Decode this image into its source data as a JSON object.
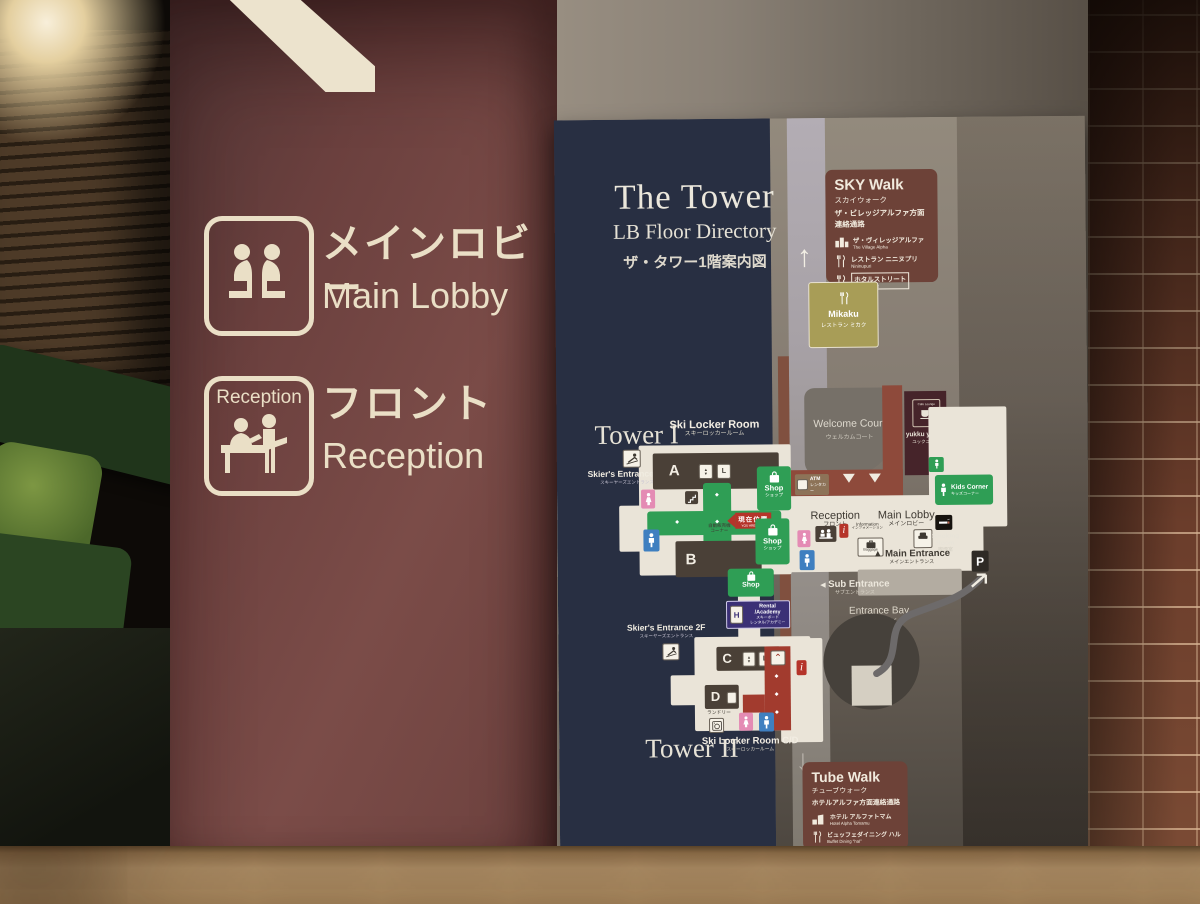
{
  "colors": {
    "wall_maroon": "#714543",
    "sign_cream": "#eadfc6",
    "board_navy": "#272e40",
    "board_gray": "#8c8379",
    "box_maroon": "#6d4238",
    "mikaku_olive": "#a89d57",
    "map_cream": "#eae4d8",
    "map_brown": "#4a4037",
    "map_green": "#2f9e55",
    "map_red": "#a23b2e",
    "rental_purple": "#3b3076",
    "marker_red": "#b5342a"
  },
  "wall_signs": {
    "main_lobby": {
      "jp": "メインロビー",
      "en": "Main Lobby"
    },
    "reception": {
      "box_label": "Reception",
      "jp": "フロント",
      "en": "Reception"
    }
  },
  "board": {
    "title": "The Tower",
    "subtitle": "LB Floor Directory",
    "subtitle_jp": "ザ・タワー1階案内図",
    "tower_1": "Tower I",
    "tower_2": "Tower II",
    "sky_walk": {
      "title": "SKY Walk",
      "jp": "スカイウォーク",
      "dest_line1": "ザ・ビレッジアルファ方面",
      "dest_line2": "連絡通路",
      "items": [
        {
          "icon": "village-building-icon",
          "jp": "ザ・ヴィレッジアルファ",
          "en": "The Village Alpha"
        },
        {
          "icon": "restaurant-icon",
          "jp": "レストラン ニニヌプリ",
          "en": "Nininupuri"
        },
        {
          "icon": "restaurant-icon",
          "jp": "ホタルストリート",
          "en": "hotalu street"
        }
      ]
    },
    "tube_walk": {
      "title": "Tube Walk",
      "jp": "チューブウォーク",
      "dest_line1": "ホテルアルファ方面連絡通路",
      "items": [
        {
          "icon": "hotel-building-icon",
          "jp": "ホテル アルファトマム",
          "en": "Hotel Alpha Tomamu"
        },
        {
          "icon": "restaurant-icon",
          "jp": "ビュッフェダイニング ハル",
          "en": "Buffet Dining \"hal\""
        }
      ]
    },
    "mikaku": {
      "en": "Mikaku",
      "jp": "レストラン ミカク"
    },
    "welcome_court": {
      "en": "Welcome Court",
      "jp": "ウェルカムコート"
    },
    "yukku": {
      "tag": "Cafe Lounge",
      "en": "yukku yukku",
      "jp": "ユックユック"
    },
    "map": {
      "ski_locker": {
        "en": "Ski Locker Room",
        "jp": "スキーロッカールーム"
      },
      "ski_locker_cd": {
        "en": "Ski Locker Room C/D",
        "jp": "スキーロッカールーム"
      },
      "skiers_entrance": {
        "en": "Skier's Entrance 2F",
        "jp": "スキーヤーズエントランス"
      },
      "reception": {
        "en": "Reception",
        "jp": "フロント"
      },
      "main_lobby": {
        "en": "Main Lobby",
        "jp": "メインロビー"
      },
      "information": {
        "en": "Information",
        "jp": "インフォメーション"
      },
      "baggage": {
        "en": "Baggage"
      },
      "lounge": {
        "en": "Lounge",
        "jp": "ラウンジ"
      },
      "smoking": {
        "en": "Smoking Room",
        "jp": "喫煙室"
      },
      "kids_corner": {
        "en": "Kids Corner",
        "jp": "キッズコーナー"
      },
      "main_entrance": {
        "en": "Main Entrance",
        "jp": "メインエントランス"
      },
      "sub_entrance": {
        "en": "Sub Entrance",
        "jp": "サブエントランス"
      },
      "entrance_bay": {
        "en": "Entrance Bay",
        "jp": "エントランスベイ"
      },
      "atm": {
        "line1": "ATM",
        "line2": "レンタカー"
      },
      "vending": {
        "line1": "自動販売機",
        "line2": "コーナー"
      },
      "laundry": "ランドリー",
      "you_are_here": {
        "jp": "現在位置",
        "en": "YOU ARE HERE"
      },
      "shop": {
        "en": "Shop",
        "jp": "ショップ"
      },
      "rental": {
        "line1": "Rental /Academy",
        "line2": "スキーボード",
        "line3": "レンタル/アカデミー"
      },
      "parking": "P",
      "buildings": [
        "A",
        "B",
        "C",
        "D"
      ]
    }
  }
}
